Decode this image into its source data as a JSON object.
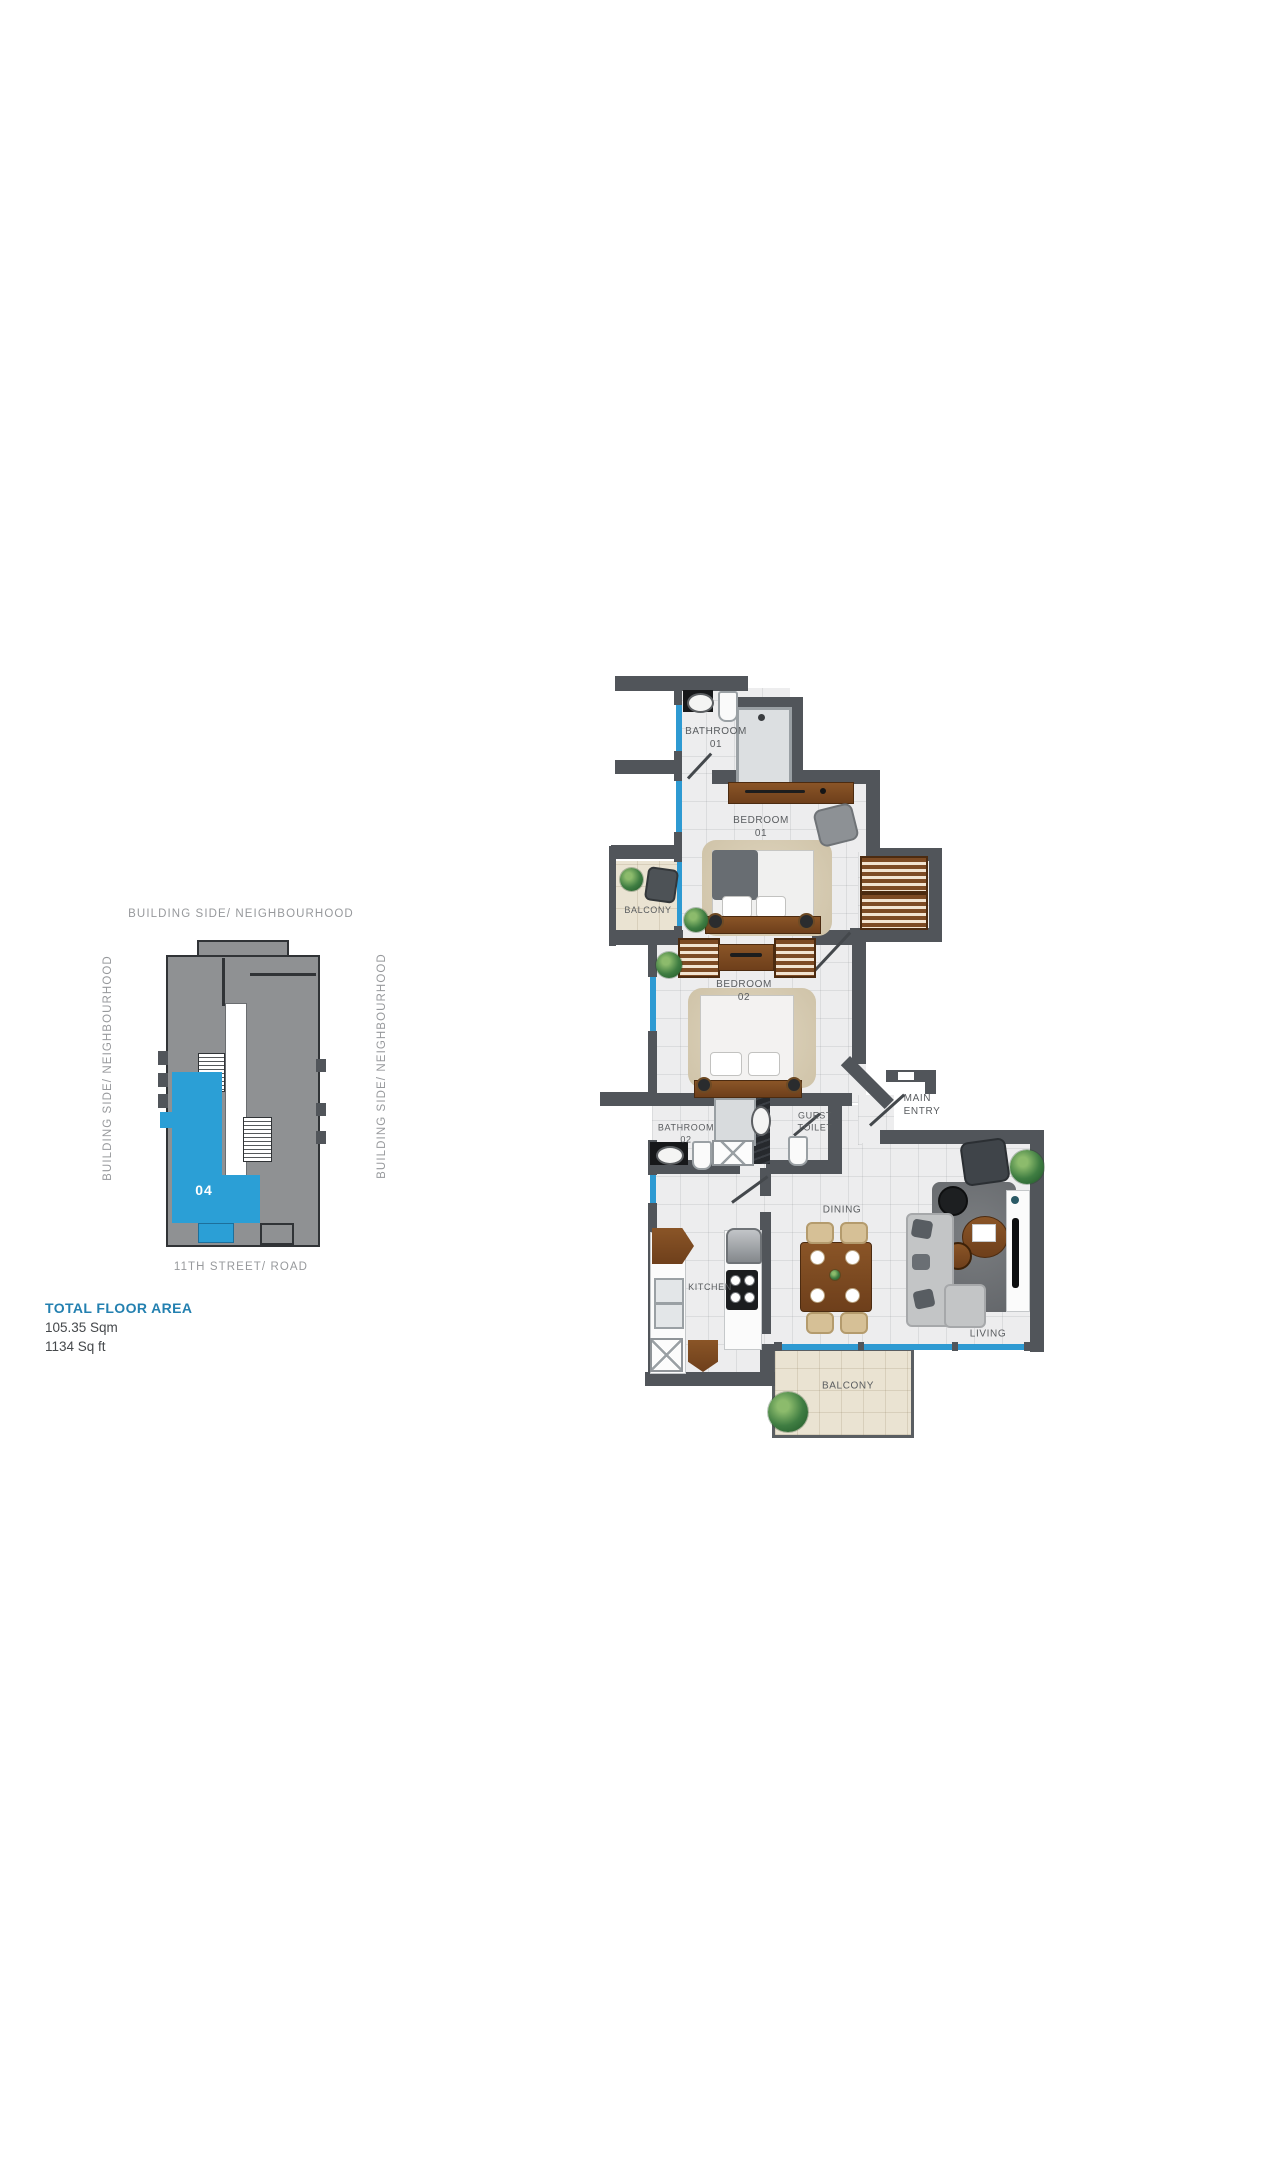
{
  "colors": {
    "accent_blue": "#2B9FD6",
    "title_blue": "#2380B0",
    "wall_dark": "#51555A",
    "floor_tile": "#EDEDEE",
    "balcony_floor": "#EAE3D2",
    "keyplan_gray": "#8F9193",
    "keyplan_outline": "#303336",
    "wood_brown": "#7C4B26",
    "window_blue": "#2E9AD2",
    "label_gray": "#595C5F",
    "side_label_gray": "#97999C"
  },
  "key_plan": {
    "top_label": "BUILDING SIDE/ NEIGHBOURHOOD",
    "left_label": "BUILDING SIDE/ NEIGHBOURHOOD",
    "right_label": "BUILDING SIDE/ NEIGHBOURHOOD",
    "street_label": "11TH STREET/ ROAD",
    "unit_number": "04"
  },
  "total_area": {
    "title": "TOTAL FLOOR AREA",
    "metric": "105.35 Sqm",
    "imperial": "1134 Sq ft"
  },
  "floor_plan": {
    "labels": {
      "bathroom01": "BATHROOM\n01",
      "bedroom01": "BEDROOM\n01",
      "balcony_top": "BALCONY",
      "bedroom02": "BEDROOM\n02",
      "bathroom02": "BATHROOM\n02",
      "guest_toilet": "GUEST\nTOILET",
      "main_entry": "MAIN\nENTRY",
      "dining": "DINING",
      "kitchen": "KITCHEN",
      "living": "LIVING",
      "balcony_bottom": "BALCONY"
    }
  }
}
